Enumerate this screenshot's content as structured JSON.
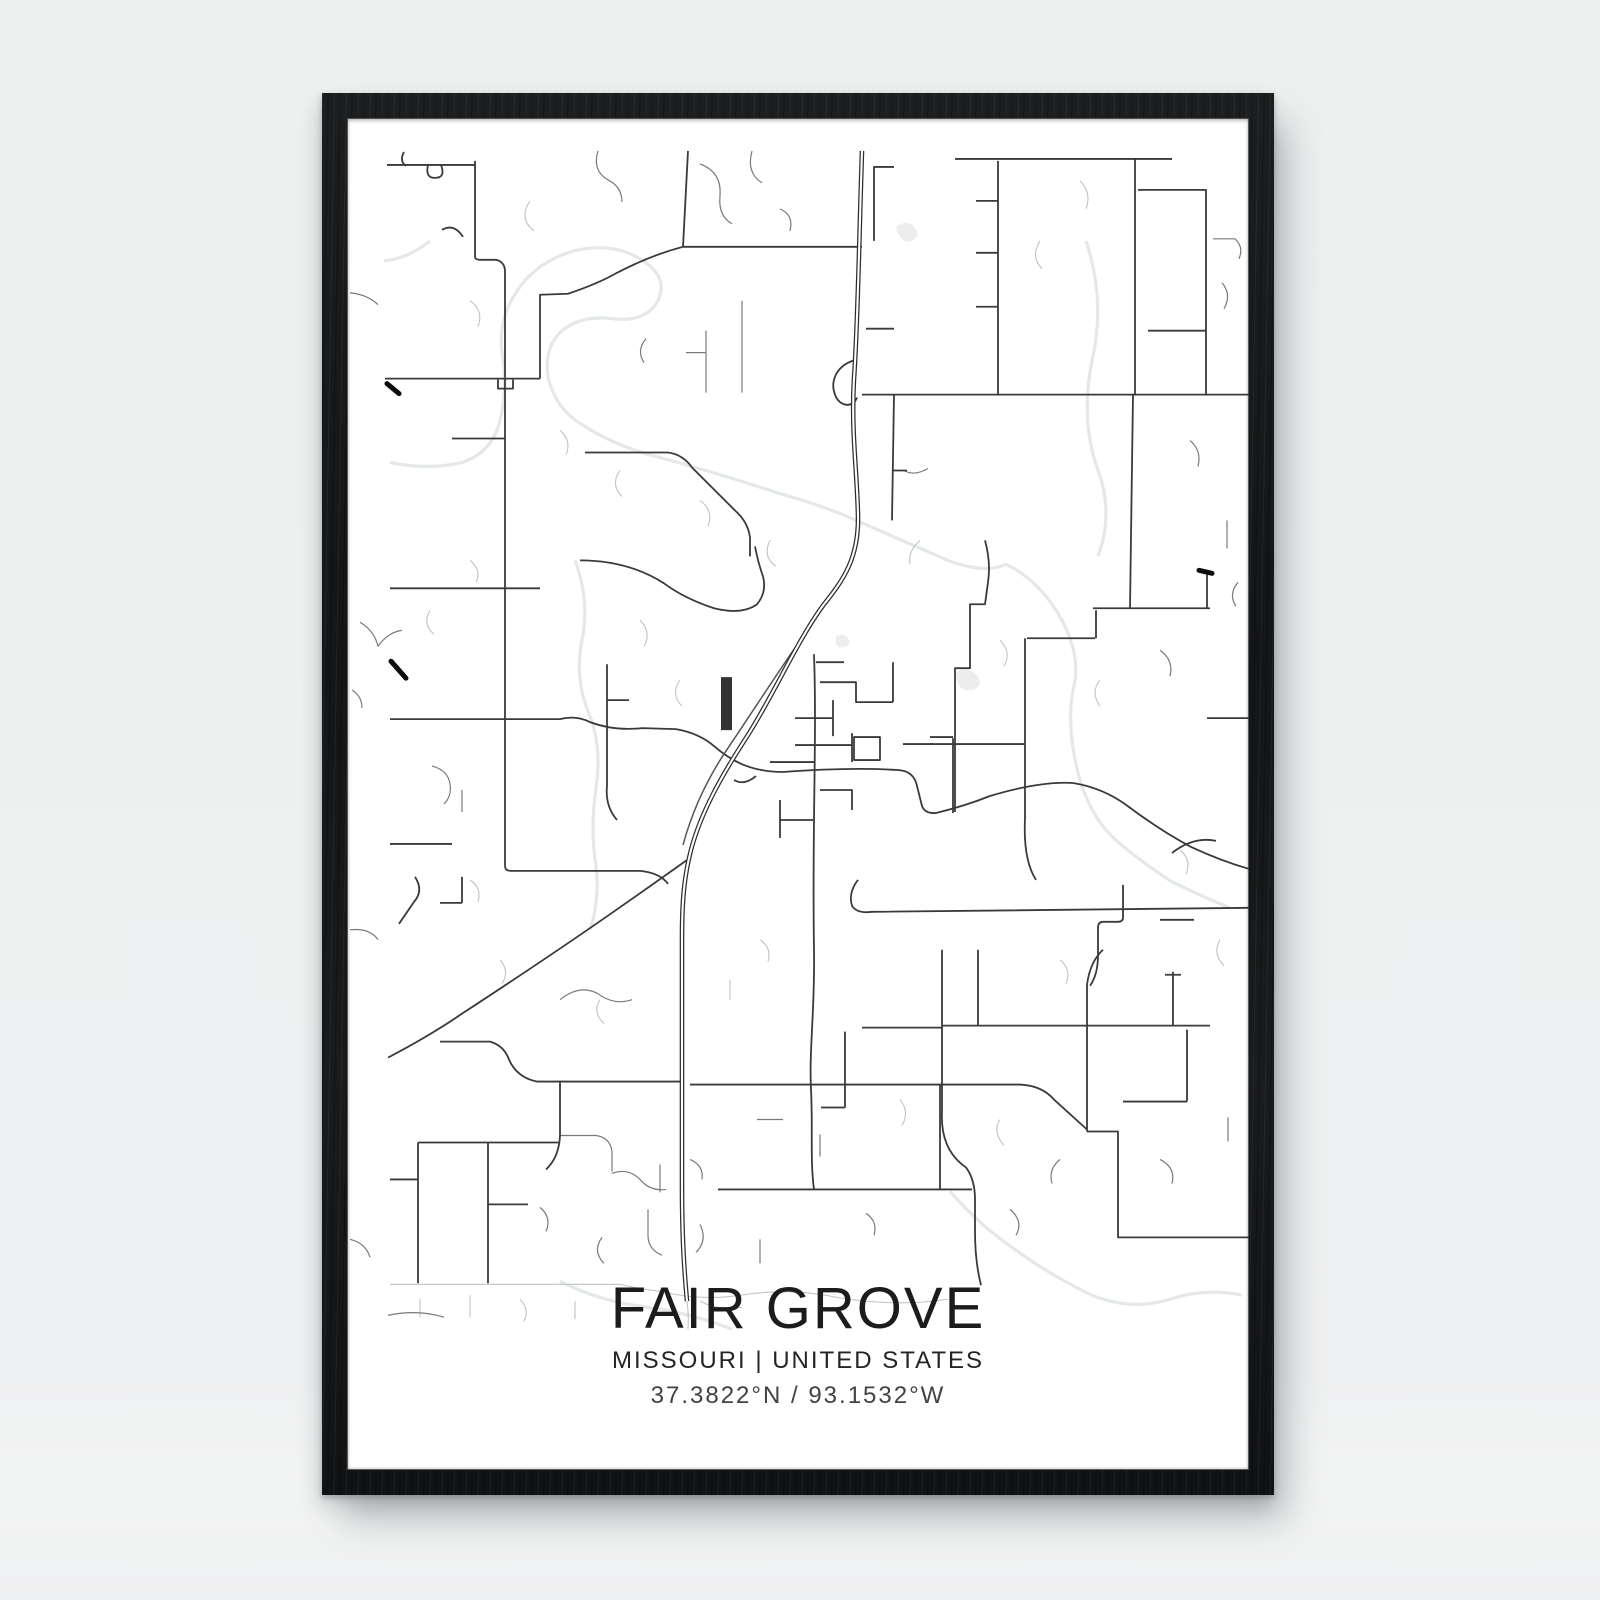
{
  "page": {
    "background": "#eff0f1"
  },
  "frame": {
    "color": "#17191b",
    "mat_color": "#ffffff"
  },
  "poster": {
    "title": "FAIR GROVE",
    "subtitle": "MISSOURI | UNITED STATES",
    "coordinates": "37.3822°N / 93.1532°W",
    "text_color": "#1c1c1c",
    "subtitle_color": "#242424",
    "coords_color": "#424242"
  },
  "map": {
    "viewBox": "347 117 902 1354",
    "layers": [
      {
        "name": "stream",
        "color": "#e4e8e8",
        "width": 3.2,
        "paths": [
          "M390,462 Q428,470 462,462 Q492,452 500,420 Q508,388 502,352 Q498,318 516,292 Q534,262 574,250 Q616,240 646,262 Q668,278 658,300 Q646,322 612,318 Q582,314 562,330 Q544,346 548,376 Q554,404 576,420 Q610,444 656,456 Q716,472 776,492 Q826,506 856,520 Q902,540 948,560 Q985,574 1006,564 Q1040,580 1062,620 Q1082,658 1073,690 Q1066,730 1080,780 Q1092,820 1118,842 Q1145,865 1172,882 Q1205,898 1230,908",
          "M575,560 Q590,600 582,640 Q574,680 590,716 Q602,748 596,788 Q590,830 596,866 Q600,900 590,930",
          "M1086,240 Q1106,300 1092,360 Q1080,420 1098,470 Q1114,512 1098,556",
          "M950,1192 Q980,1226 1012,1248 Q1050,1276 1092,1296 Q1132,1312 1170,1300 Q1206,1288 1242,1296",
          "M560,1282 Q600,1302 642,1307 Q692,1314 732,1330",
          "M430,240 Q408,258 384,260"
        ]
      },
      {
        "name": "pond",
        "color": "#ededed",
        "width": 0,
        "fill": true,
        "paths": [
          "M896,226 q10,-8 18,0 q8,8 -2,14 q-12,4 -16,-14 z",
          "M956,672 q14,-6 22,4 q6,10 -6,14 q-16,2 -16,-18 z",
          "M836,636 q8,-4 12,2 q4,6 -4,9 q-10,2 -8,-11 z"
        ]
      },
      {
        "name": "road-faint",
        "color": "#c0c3c3",
        "width": 1.1,
        "paths": [
          "M530,200 q-12,18 4,30",
          "M470,300 q14,10 8,26",
          "M560,430 q12,10 6,24 M620,470 q-10,14 2,26",
          "M700,500 q14,10 8,26 M770,540 q-8,16 6,26",
          "M640,620 q12,12 4,26 M680,680 q-10,14 2,26",
          "M470,560 q12,10 6,22 M430,610 q-8,14 4,24",
          "M1000,640 q12,12 4,26 M1100,680 q-10,12 0,26",
          "M1180,850 q12,10 6,24 M1220,940 q-8,14 4,26",
          "M1060,960 q12,10 6,24",
          "M500,960 q10,12 2,24 M600,1000 q-8,12 4,24",
          "M900,1100 q10,12 2,26 M1000,1120 q-8,12 4,26",
          "M390,1285 H620 Q640,1290 660,1292",
          "M660,1292 q40,10 80,4 q50,-8 96,2 q60,10 112,2",
          "M700,1302 q20,10 42,6",
          "M1040,240 q-10,16 2,28 M1080,180 q12,12 6,28",
          "M920,540 q-12,10 -10,24",
          "M470,880 q12,8 8,22",
          "M760,940 q12,8 8,22 M730,980 v20",
          "M687,1302 q2,16 1,28",
          "M420,1300 v18 M470,1296 v22 M520,1300 q10,10 4,22 M575,1302 v18"
        ]
      },
      {
        "name": "road-minor",
        "color": "#7a7a7a",
        "width": 1.2,
        "paths": [
          "M350,292 q18,2 28,12",
          "M360,622 q14,8 18,24 q10,-14 24,-16",
          "M352,690 q10,6 10,18",
          "M432,766 q16,4 18,18 q2,12 -6,20 M462,790 v22",
          "M350,930 q20,-2 28,10",
          "M598,150 q-6,20 10,29 q14,7 14,22",
          "M700,163 q22,8 20,32 q-2,20 12,28 M752,150 q-6,22 10,32",
          "M780,208 q14,6 10,22",
          "M646,338 q-10,12 -2,24",
          "M742,300 V392 M706,330 V392 M706,352 h-20",
          "M1190,440 q12,10 8,26 M1227,520 v28",
          "M1160,650 q14,10 10,26 M1238,582 q-10,12 -2,24",
          "M560,1000 q20,-16 38,-6 q16,12 34,6",
          "M540,1208 q12,10 6,24 M602,1238 q-10,14 2,26 M660,1165 v28",
          "M700,1225 q8,16 -4,28 M757,1120 h26 M820,1135 v22",
          "M560,1136 h36 q14,2 16,16 v20",
          "M612,1174 q16,-6 28,6 q10,12 26,10 M648,1210 v26 q0,14 14,20",
          "M866,1214 q12,8 8,22 M760,1240 v24",
          "M1160,1160 q16,8 12,24 M1228,1118 v24",
          "M1060,1160 q-12,10 -8,24 M1010,1210 q14,12 6,26",
          "M388,1316 q30,-6 56,2 M350,1240 q16,4 20,18",
          "M928,468 q-14,8 -24,2",
          "M690,1160 q14,6 12,20",
          "M1213,238 h22 q9,8 4,20",
          "M1222,282 q10,12 2,26"
        ]
      },
      {
        "name": "road-major",
        "color": "#3a3a3a",
        "width": 1.8,
        "paths": [
          "M387,164 H475 M404,151 q-5,9 2,14 M428,164 q-3,13 7,13 q11,0 6,-13",
          "M475,160 V256 Q475,259 480,259 L496,259 Q505,261 505,271 V377",
          "M442,229 q12,-7 21,7",
          "M385,378 H540 M498,379 v9 h15 v-9",
          "M540,378 V294 L568,293 Q598,283 617,272 Q652,254 683,246",
          "M688,150 L683,246",
          "M683,246 H862",
          "M874,240 V166 H894 M866,328 h28",
          "M505,378 V866",
          "M390,588 H540",
          "M452,438 H505",
          "M505,866 Q505,871 511,871 H640 Q660,873 668,884",
          "M390,719 H560 Q576,715 590,722 Q614,731 642,728 L676,729 Q699,733 714,746 Q729,759 744,765 Q762,772 783,772",
          "M607,664 V786 Q605,806 617,820 M607,700 h22",
          "M390,844 h62 M415,877 q9,14 -1,25 l-15,22 M440,903 h22 M462,877 v26",
          "M585,452 H668 Q683,454 692,467 L738,513 Q748,523 750,537 V556",
          "M580,560 Q628,560 664,583 Q684,598 714,608 Q742,615 757,604 Q767,592 763,576 Q758,562 755,546",
          "M853,360 C836,366 830,381 835,394 C839,406 853,408 857,397",
          "M862,394 H1249",
          "M894,394 L892,520 M892,470 h15",
          "M955,158 H1172",
          "M998,160 V394 M976,200 h22 M976,252 h22 M976,306 h22",
          "M1135,158 V394",
          "M1138,189 H1206 V330 H1148 M1206,330 V394",
          "M1133,394 L1130,608",
          "M1093,608 H1210 M1096,610 V638 M1027,638 H1095",
          "M1025,638 V818 Q1023,860 1036,880",
          "M930,744 H1025 M930,737 H953 M953,738 V813",
          "M985,540 Q991,562 988,582 L985,604 L970,604 V668 L955,668 V812",
          "M1207,572 V608",
          "M783,772 Q850,767 898,770 Q914,771 917,786 L922,806 Q925,814 936,813 Q965,806 990,796 Q1040,781 1073,783 Q1104,788 1129,807 Q1161,831 1191,847 Q1221,861 1249,869",
          "M1172,853 q22,-17 44,-12",
          "M858,880 Q848,893 852,906 Q857,914 872,912 L1249,908",
          "M862,1028 H942 M942,1026 H1210",
          "M978,950 V1026",
          "M942,950 V1112 Q940,1150 966,1168 Q975,1180 975,1200 V1232 Q975,1262 981,1286",
          "M1103,950 Q1090,962 1087,985 V1132",
          "M1123,885 V918 Q1123,922 1117,922 H1103 Q1098,922 1098,928 V955 Q1098,975 1090,986 M1160,920 h34",
          "M1087,1132 H1118 V1238 H1249",
          "M1123,1102 H1187 M1187,1030 V1102",
          "M1173,972 V1026 M1165,975 h16",
          "M718,1190 H972",
          "M940,1085 V1190",
          "M690,1085 H940",
          "M940,1085 H1020 Q1042,1086 1054,1100 L1087,1130",
          "M537,1082 H682",
          "M814,654 C817,740 812,830 814,950 C815,1010 809,1050 811,1090 C813,1130 810,1160 814,1190",
          "M388,1058 Q430,1036 462,1014 Q540,963 602,920 Q648,888 690,858",
          "M440,1042 H490 Q504,1046 509,1060 Q517,1078 537,1082",
          "M560,1082 V1136 Q559,1158 546,1170",
          "M418,1143 V1284 M488,1143 V1284 M418,1143 H560 M418,1180 h-28 M488,1205 h40",
          "M816,662 h28 M820,682 H856 V702 H893 M893,662 V702",
          "M795,718 h38 M833,700 v36 M795,745 h57 M852,733 v29",
          "M854,737 h26 v23 h-26 z",
          "M770,762 h45 M820,790 h32 v20 M780,800 v38 M780,820 h33 M756,776 q-12,10 -22,4 M903,744 h30",
          "M845,1032 V1108 M845,1108 h-24",
          "M1207,718 H1249"
        ]
      },
      {
        "name": "highway-old",
        "color": "#555555",
        "width": 1.5,
        "paths": [
          "M820,612 C792,650 757,705 730,745 C707,778 692,812 683,845"
        ]
      },
      {
        "name": "highway-casing",
        "color": "#2d2d2d",
        "width": 4.6,
        "paths": [
          "M862,150 C859,240 858,320 854,378 C851,432 857,468 858,515 C859,558 843,580 824,604 C799,637 772,698 746,738 C722,775 701,812 691,850 C684,877 682,902 682,938 L682,1186 C682,1238 684,1268 687,1302"
        ]
      },
      {
        "name": "highway-core",
        "color": "#ffffff",
        "width": 2.1,
        "paths": [
          "M862,150 C859,240 858,320 854,378 C851,432 857,468 858,515 C859,558 843,580 824,604 C799,637 772,698 746,738 C722,775 701,812 691,850 C684,877 682,902 682,938 L682,1186 C682,1238 684,1268 687,1302"
        ]
      },
      {
        "name": "bold-dash",
        "color": "#0d0d0d",
        "width": 5,
        "linecap": "round",
        "paths": [
          "M387,383 l12,10",
          "M391,661 l15,17",
          "M1199,570 l13,3"
        ]
      },
      {
        "name": "filled-block",
        "color": "#333333",
        "width": 0,
        "fill": true,
        "paths": [
          "M721,677 h11 v53 h-11 z"
        ]
      }
    ]
  }
}
